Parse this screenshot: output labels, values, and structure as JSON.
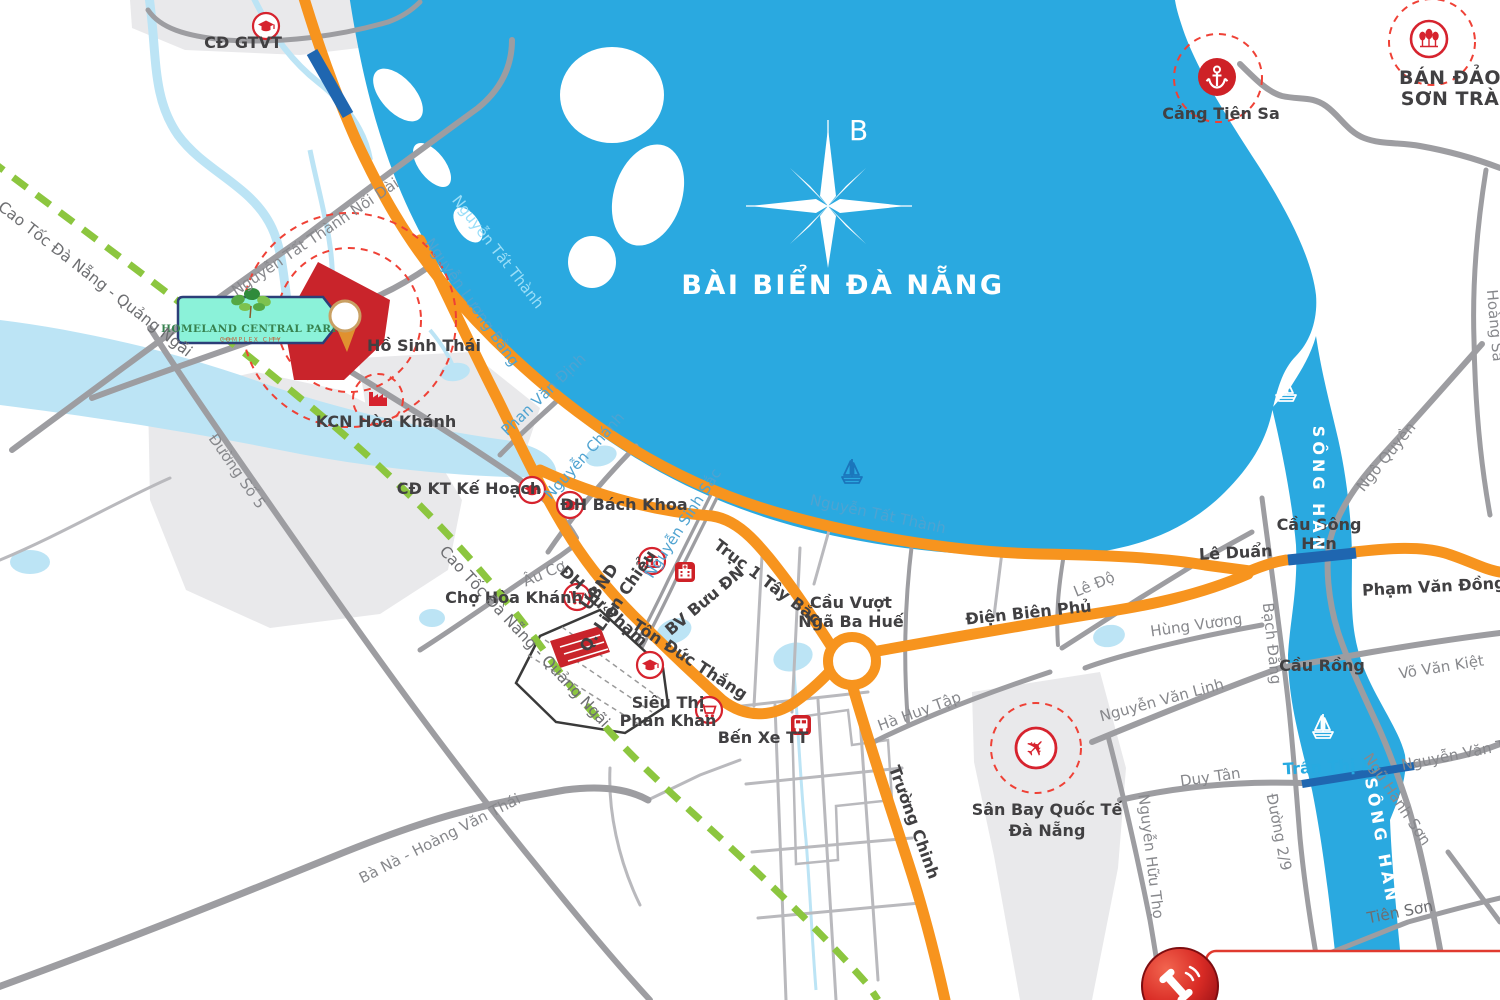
{
  "project": {
    "name": "HOMELAND CENTRAL PARK",
    "subtitle": "COMPLEX CITY"
  },
  "sea": {
    "name": "BÀI BIỂN ĐÀ NẴNG"
  },
  "river": {
    "name": "SÔNG HÀN"
  },
  "compass": {
    "north": "B"
  },
  "pois": {
    "cd_gtvt": "CĐ GTVT",
    "cang_tien_sa": "Cảng Tiên Sa",
    "ban_dao_son_tra": {
      "line1": "BÁN ĐẢO",
      "line2": "SƠN TRÀ"
    },
    "ho_sinh_thai": "Hồ Sinh Thái",
    "kcn_hoa_khanh": "KCN Hòa Khánh",
    "cd_kt_ke_hoach": "CĐ KT Kế Hoạch",
    "dh_bach_khoa": "ĐH Bách Khoa",
    "cho_hoa_khanh": "Chợ Hòa Khánh",
    "ubnd_lien_chieu": {
      "line1": "UBND",
      "line2": "Q. Liên Chiểu"
    },
    "bv_buu_dn": "BV Bưu ĐN",
    "dh_su_pham": "ĐH Sư Phạm",
    "sieu_thi_phan_khan": {
      "line1": "Siêu Thị",
      "line2": "Phan Khan"
    },
    "ben_xe_tt": "Bến Xe TT",
    "san_bay": {
      "line1": "Sân Bay Quốc Tế",
      "line2": "Đà Nẵng"
    }
  },
  "bridges": {
    "nga_ba_hue": {
      "line1": "Cầu Vượt",
      "line2": "Ngã Ba Huế"
    },
    "song_han": {
      "line1": "Cầu Sông",
      "line2": "Hàn"
    },
    "rong": "Cầu Rồng",
    "tran_thi_ly": "Trần Thị Lý",
    "tien_son": "Tiên Sơn"
  },
  "roads": {
    "cao_toc": "Cao Tốc Đà Nẵng - Quảng Ngãi",
    "duong_so_5": "Đường Số 5",
    "ba_na_hoang_van_thai": "Bà Nà - Hoàng Văn Thái",
    "nguyen_tat_thanh_noi_dai": "Nguyễn Tất Thành Nối Dài",
    "nguyen_tat_thanh": "Nguyễn Tất Thành",
    "nguyen_luong_bang": "Nguyễn Lương Bằng",
    "phan_van_dinh": "Phan Văn Định",
    "nguyen_chanh": "Nguyễn Chánh",
    "nguyen_sinh_sac": "Nguyễn Sinh Sắc",
    "au_co": "Âu Cơ",
    "truc_1_tay_bac": "Trục 1 Tây Bắc",
    "ton_duc_thang": "Tôn Đức Thắng",
    "dien_bien_phu": "Điện Biên Phủ",
    "truong_chinh": "Trường Chinh",
    "ha_huy_tap": "Hà Huy Tập",
    "le_do": "Lê Độ",
    "le_duan": "Lê Duẩn",
    "pham_van_dong": "Phạm Văn Đồng",
    "hung_vuong": "Hùng Vương",
    "bach_dang": "Bạch Đằng",
    "ngo_quyen": "Ngô Quyền",
    "hoang_sa": "Hoàng Sa",
    "nguyen_van_linh": "Nguyễn Văn Linh",
    "vo_van_kiet": "Võ Văn Kiệt",
    "duy_tan": "Duy Tân",
    "nguyen_van_thoai": "Nguyễn Văn Thoại",
    "ngu_hanh_son": "Ngũ Hành Sơn",
    "duong_2_9": "Đường 2/9",
    "nguyen_huu_tho": "Nguyễn Hữu Thọ",
    "tien_son": "Tiên Sơn"
  },
  "icons": {
    "university": "graduation-cap",
    "market": "shopping-cart",
    "government": "government-building",
    "hospital": "hospital-building",
    "bus_station": "bus",
    "industrial": "factory",
    "port": "anchor",
    "peninsula": "trees",
    "airport": "airplane",
    "hotline": "phone",
    "marina": "sailboat",
    "project_marker": "map-pin",
    "compass": "compass-rose"
  },
  "colors": {
    "sea": "#2aa9e0",
    "shallow_water": "#bce4f5",
    "road_primary": "#f7941e",
    "road_secondary": "#9d9da1",
    "expressway_planned": "#8cc63f",
    "bridge_blue": "#1f66b0",
    "accent_red": "#d6232e",
    "site_red": "#c9242b",
    "land_gray": "#e9e9eb",
    "label_dark": "#414042",
    "label_gray": "#87888c",
    "label_blue": "#4fa3d1",
    "logo_bg": "#8bf2d9",
    "logo_border": "#2c3e78"
  }
}
